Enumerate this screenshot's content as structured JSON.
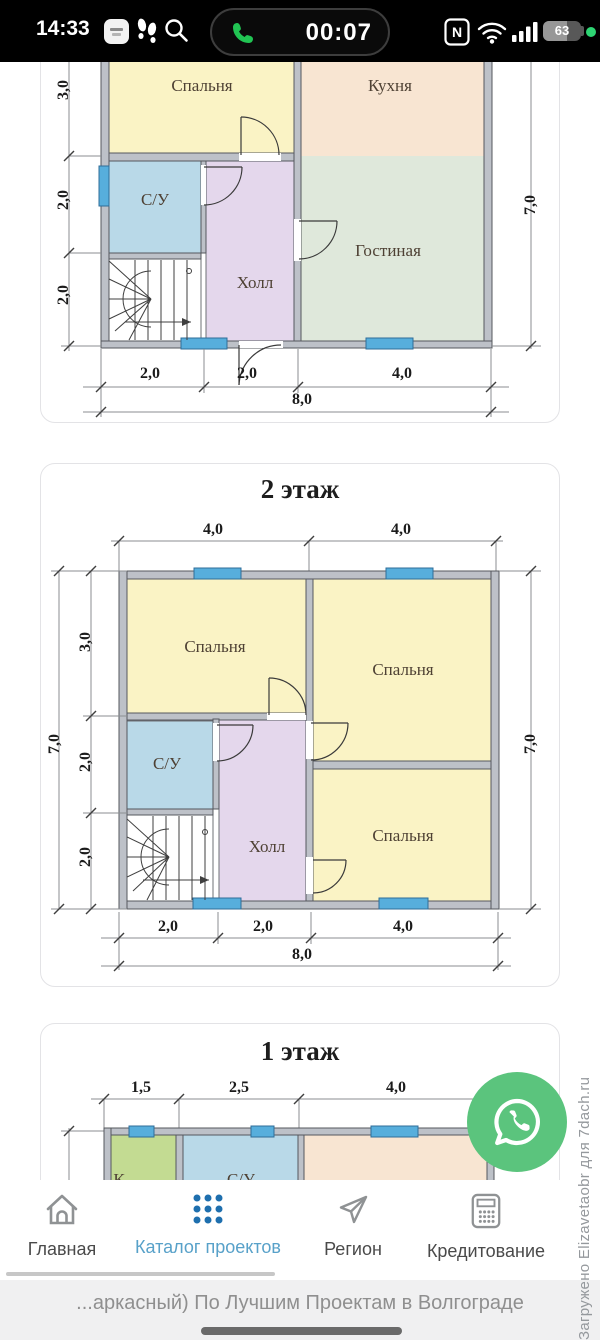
{
  "status_bar": {
    "time": "14:33",
    "call_timer": "00:07",
    "battery_percent": "63",
    "nfc_label": "N"
  },
  "floor_top": {
    "rooms": {
      "bedroom": "Спальня",
      "kitchen": "Кухня",
      "bathroom": "С/У",
      "hall": "Холл",
      "living_room": "Гостиная"
    },
    "dims": {
      "left_3": "3,0",
      "left_2a": "2,0",
      "left_2b": "2,0",
      "right_total": "7,0",
      "bottom_1": "2,0",
      "bottom_2": "2,0",
      "bottom_3": "4,0",
      "bottom_total": "8,0"
    }
  },
  "floor_2": {
    "title": "2 этаж",
    "rooms": {
      "bedroom_tl": "Спальня",
      "bedroom_r": "Спальня",
      "bedroom_br": "Спальня",
      "bathroom": "С/У",
      "hall": "Холл"
    },
    "dims": {
      "top_1": "4,0",
      "top_2": "4,0",
      "left_total": "7,0",
      "left_3": "3,0",
      "left_2a": "2,0",
      "left_2b": "2,0",
      "right_total": "7,0",
      "bottom_1": "2,0",
      "bottom_2": "2,0",
      "bottom_3": "4,0",
      "bottom_total": "8,0"
    }
  },
  "floor_1": {
    "title": "1 этаж",
    "dims": {
      "top_1": "1,5",
      "top_2": "2,5",
      "top_3": "4,0"
    },
    "partial_rooms": {
      "left": "К",
      "middle": "С/У"
    }
  },
  "nav": {
    "home": "Главная",
    "catalog": "Каталог проектов",
    "region": "Регион",
    "credit": "Кредитование"
  },
  "footer": {
    "marquee": "...аркасный) По Лучшим Проектам в Волгограде"
  },
  "watermark": "Загружено Elizavetaobr для 7dach.ru",
  "colors": {
    "accent_blue": "#1e6fae",
    "active_label_blue": "#58A1C9",
    "whatsapp_green": "#5BC47D",
    "window_blue": "#57AEDC",
    "room_yellow": "#FAF3C5",
    "room_peach": "#F8E5D2",
    "room_sage": "#DFE8DB",
    "room_blue": "#B9D9E8",
    "room_purple": "#E4D7EC",
    "room_lime": "#C3DB92",
    "call_green": "#21C453"
  }
}
